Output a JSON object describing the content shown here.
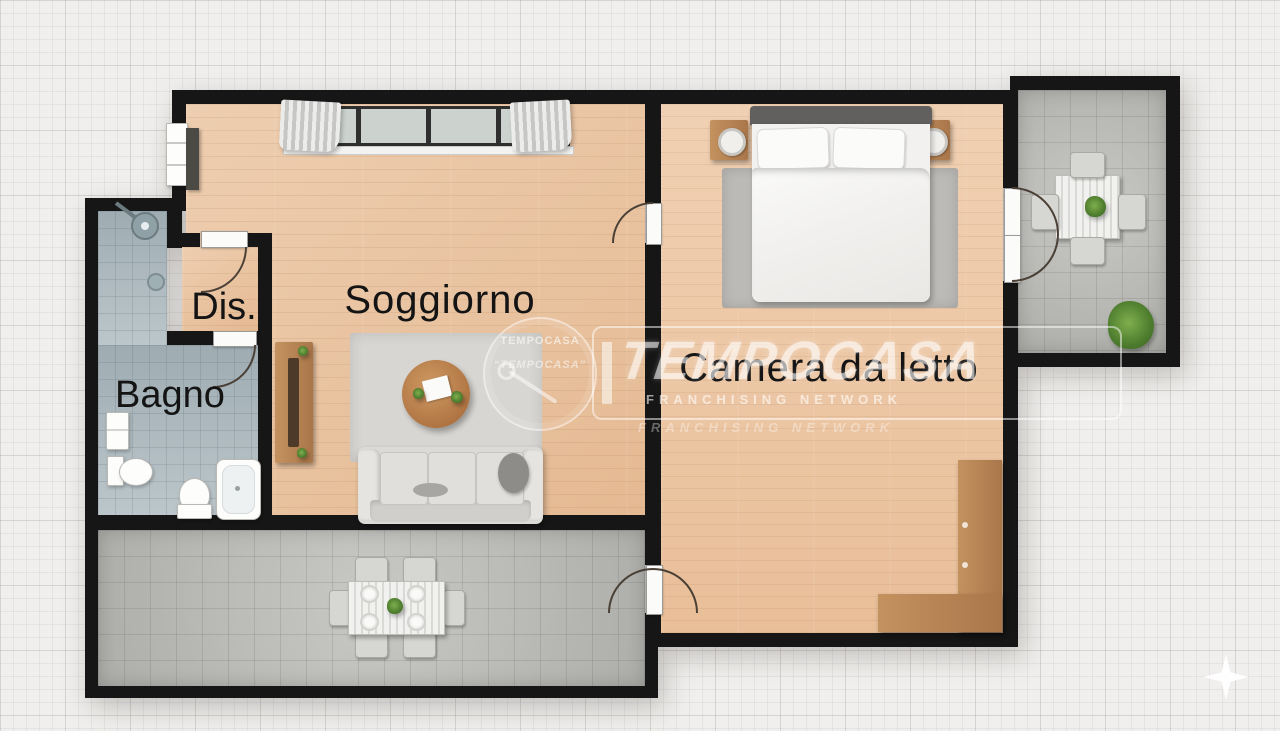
{
  "page": {
    "type": "floor-plan",
    "language": "it"
  },
  "rooms": {
    "soggiorno": {
      "label": "Soggiorno"
    },
    "camera_da_letto": {
      "label": "Camera da letto"
    },
    "bagno": {
      "label": "Bagno"
    },
    "disimpegno": {
      "label": "Dis."
    }
  },
  "watermark": {
    "badge_brand_top": "TEMPOCASA",
    "badge_brand_bottom": "“TEMPOCASA”",
    "brand": "TEMPOCASA",
    "network": "FRANCHISING NETWORK",
    "network_shadow": "FRANCHISING NETWORK"
  },
  "colors": {
    "wall": "#161616",
    "wood_living": "#e9c09a",
    "wood_bedroom": "#edc6a2",
    "tile_outdoor": "#bcbcb8",
    "tile_bath": "#b4c0c5",
    "background": "#f0efed",
    "label_text": "#141414",
    "watermark_white": "#ffffff"
  }
}
